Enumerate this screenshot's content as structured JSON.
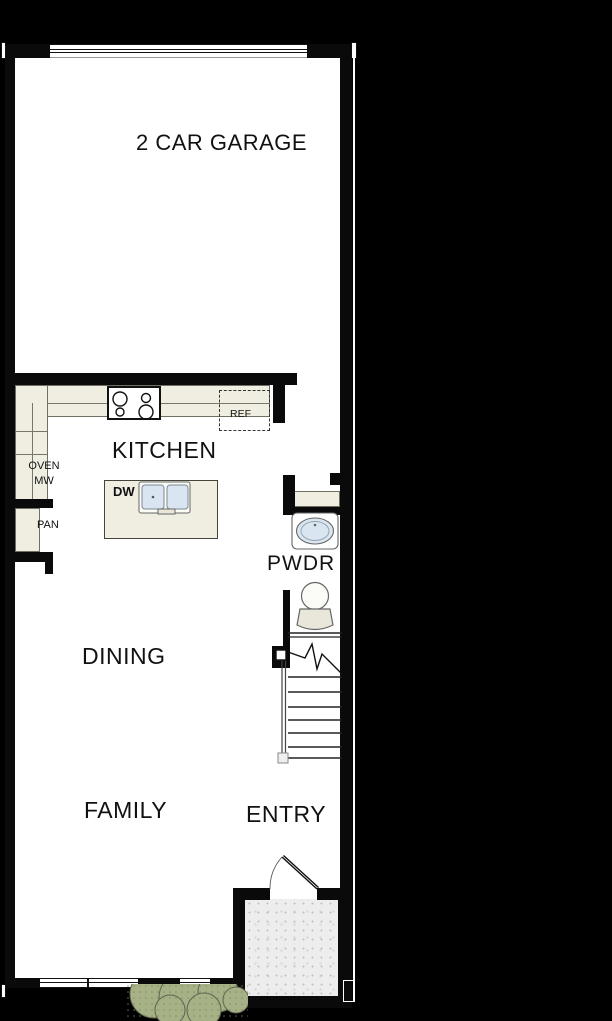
{
  "plan": {
    "rooms": {
      "garage": "2 CAR GARAGE",
      "kitchen": "KITCHEN",
      "dining": "DINING",
      "family": "FAMILY",
      "entry": "ENTRY",
      "powder": "PWDR"
    },
    "fixtures": {
      "oven_line1": "OVEN",
      "oven_line2": "MW",
      "pantry": "PAN",
      "refrigerator": "REF",
      "dishwasher": "DW"
    }
  },
  "colors": {
    "background": "#000000",
    "wall": "#0a0a0a",
    "floor": "#ffffff",
    "counter": "#efeee1",
    "sink": "#d9e6f1",
    "porch": "#ededed",
    "speckle": "#bfbfbf",
    "bush": "#a6b185",
    "bush_outline": "#5f6450",
    "text": "#111111"
  }
}
